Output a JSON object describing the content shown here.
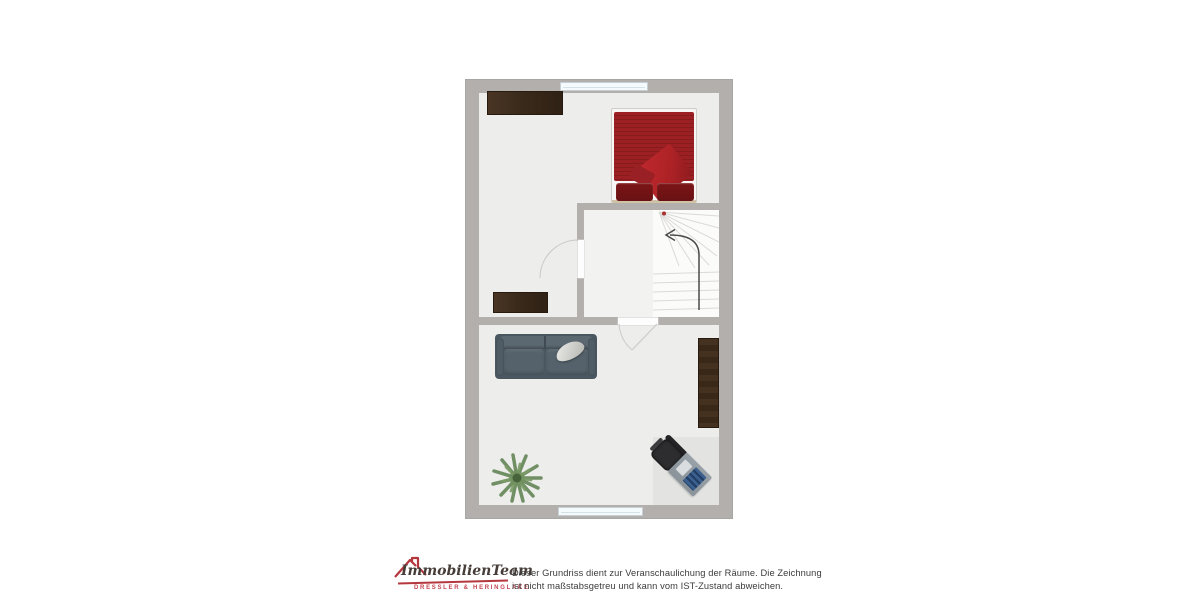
{
  "floorplan": {
    "type": "top-down floor plan, one storey",
    "colors": {
      "wall": "#b2afac",
      "floor": "#ededec",
      "stair-floor": "#f2f2f1",
      "rug": "#e3e3e1",
      "window": "#f5fafc",
      "bed-red": "#9c2023",
      "bed-throw": "#ad2226",
      "bed-pillow": "#691113",
      "sofa": "#4b5760",
      "chair-dark": "#2d2d2f",
      "desk-blue": "#3b5f8f",
      "plant-green": "#5c7f4d",
      "arrow": "#4a4a4a",
      "stair-dot": "#b03030",
      "logo-red": "#b5373e"
    },
    "rooms": [
      {
        "name": "bedroom",
        "furniture": [
          "wardrobe",
          "double-bed",
          "dresser"
        ]
      },
      {
        "name": "staircase-hall",
        "furniture": [
          "winder-stairs",
          "direction-arrow"
        ]
      },
      {
        "name": "living-room",
        "furniture": [
          "sofa",
          "tall-wardrobe",
          "plant",
          "office-chair",
          "desk"
        ]
      }
    ],
    "openings": {
      "windows": 2,
      "doors": 2
    }
  },
  "footer": {
    "logo": {
      "brand": "ImmobilienTeam",
      "subtitle": "DRESSLER & HERINGLAKE",
      "red": "#b5373e"
    },
    "disclaimer": {
      "line1": "Dieser Grundriss dient zur Veranschaulichung der Räume. Die Zeichnung",
      "line2": "ist nicht maßstabsgetreu und kann vom IST-Zustand abweichen."
    }
  }
}
